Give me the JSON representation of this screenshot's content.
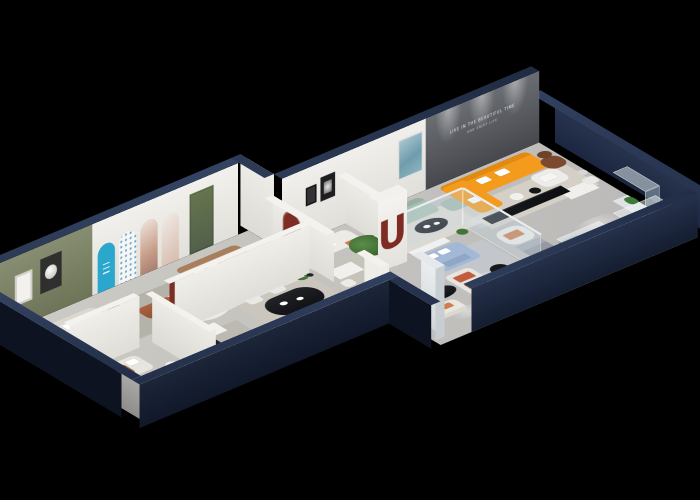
{
  "scene": {
    "type": "3d-isometric-cutaway-floorplan-render",
    "background": "#000000",
    "wall_slogan_line1": "LIVE IN THE BEAUTIFUL TIME",
    "wall_slogan_line2": "AND ENJOY LIFE",
    "letter_arch_panel": "N",
    "letter_column": "U",
    "palette": {
      "outer_wall_navy": "#22304a",
      "wall_cap_navy": "#2c3a55",
      "inner_wall_white": "#ecebe7",
      "accent_green_wall": "#7b8166",
      "accent_cyan_arch": "#2ba7cd",
      "accent_maroon": "#7c2d24",
      "sofa_orange": "#f49b1d",
      "sofa_sage": "#a9bfb0",
      "sofa_blue": "#a2b8d6",
      "cushion_coral": "#c25c3c",
      "floor_gray": "#c9c7c2",
      "media_wall_gray": "#55585c",
      "plant_green": "#3c6b33"
    }
  }
}
